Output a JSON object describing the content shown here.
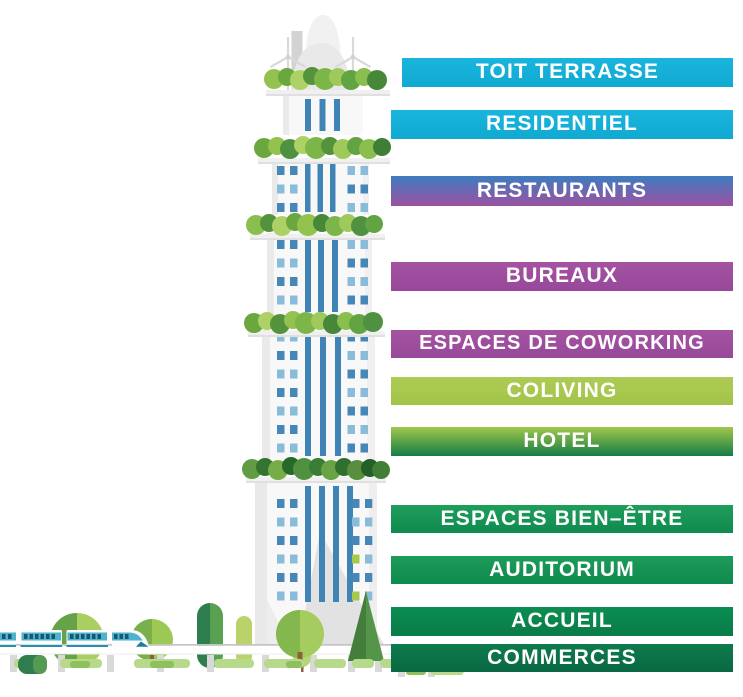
{
  "title": "Mixed-use tower program diagram",
  "bars": [
    {
      "id": "toit-terrasse",
      "label": "TOIT TERRASSE",
      "color_top": "#1ab5dc",
      "color_bottom": "#0fa9d2"
    },
    {
      "id": "residentiel",
      "label": "RESIDENTIEL",
      "color_top": "#1ab5dc",
      "color_bottom": "#0fa9d2"
    },
    {
      "id": "restaurants",
      "label": "RESTAURANTS",
      "color_top": "#3e7cc0",
      "color_bottom": "#9d51a0"
    },
    {
      "id": "bureaux",
      "label": "BUREAUX",
      "color_top": "#a553a1",
      "color_bottom": "#97489a"
    },
    {
      "id": "espaces-de-coworking",
      "label": "ESPACES DE COWORKING",
      "color_top": "#a553a1",
      "color_bottom": "#97489a"
    },
    {
      "id": "coliving",
      "label": "COLIVING",
      "color_top": "#aecb55",
      "color_bottom": "#a2c447"
    },
    {
      "id": "hotel",
      "label": "HOTEL",
      "color_top": "#a2c74c",
      "color_bottom": "#157c46"
    },
    {
      "id": "espaces-bien-etre",
      "label": "ESPACES BIEN–ÊTRE",
      "color_top": "#1f9e5a",
      "color_bottom": "#108a50"
    },
    {
      "id": "auditorium",
      "label": "AUDITORIUM",
      "color_top": "#1c9c59",
      "color_bottom": "#108a4f"
    },
    {
      "id": "accueil",
      "label": "ACCUEIL",
      "color_top": "#0a8e52",
      "color_bottom": "#0a7b47"
    },
    {
      "id": "commerces",
      "label": "COMMERCES",
      "color_top": "#0d7b4c",
      "color_bottom": "#0a6843"
    }
  ]
}
